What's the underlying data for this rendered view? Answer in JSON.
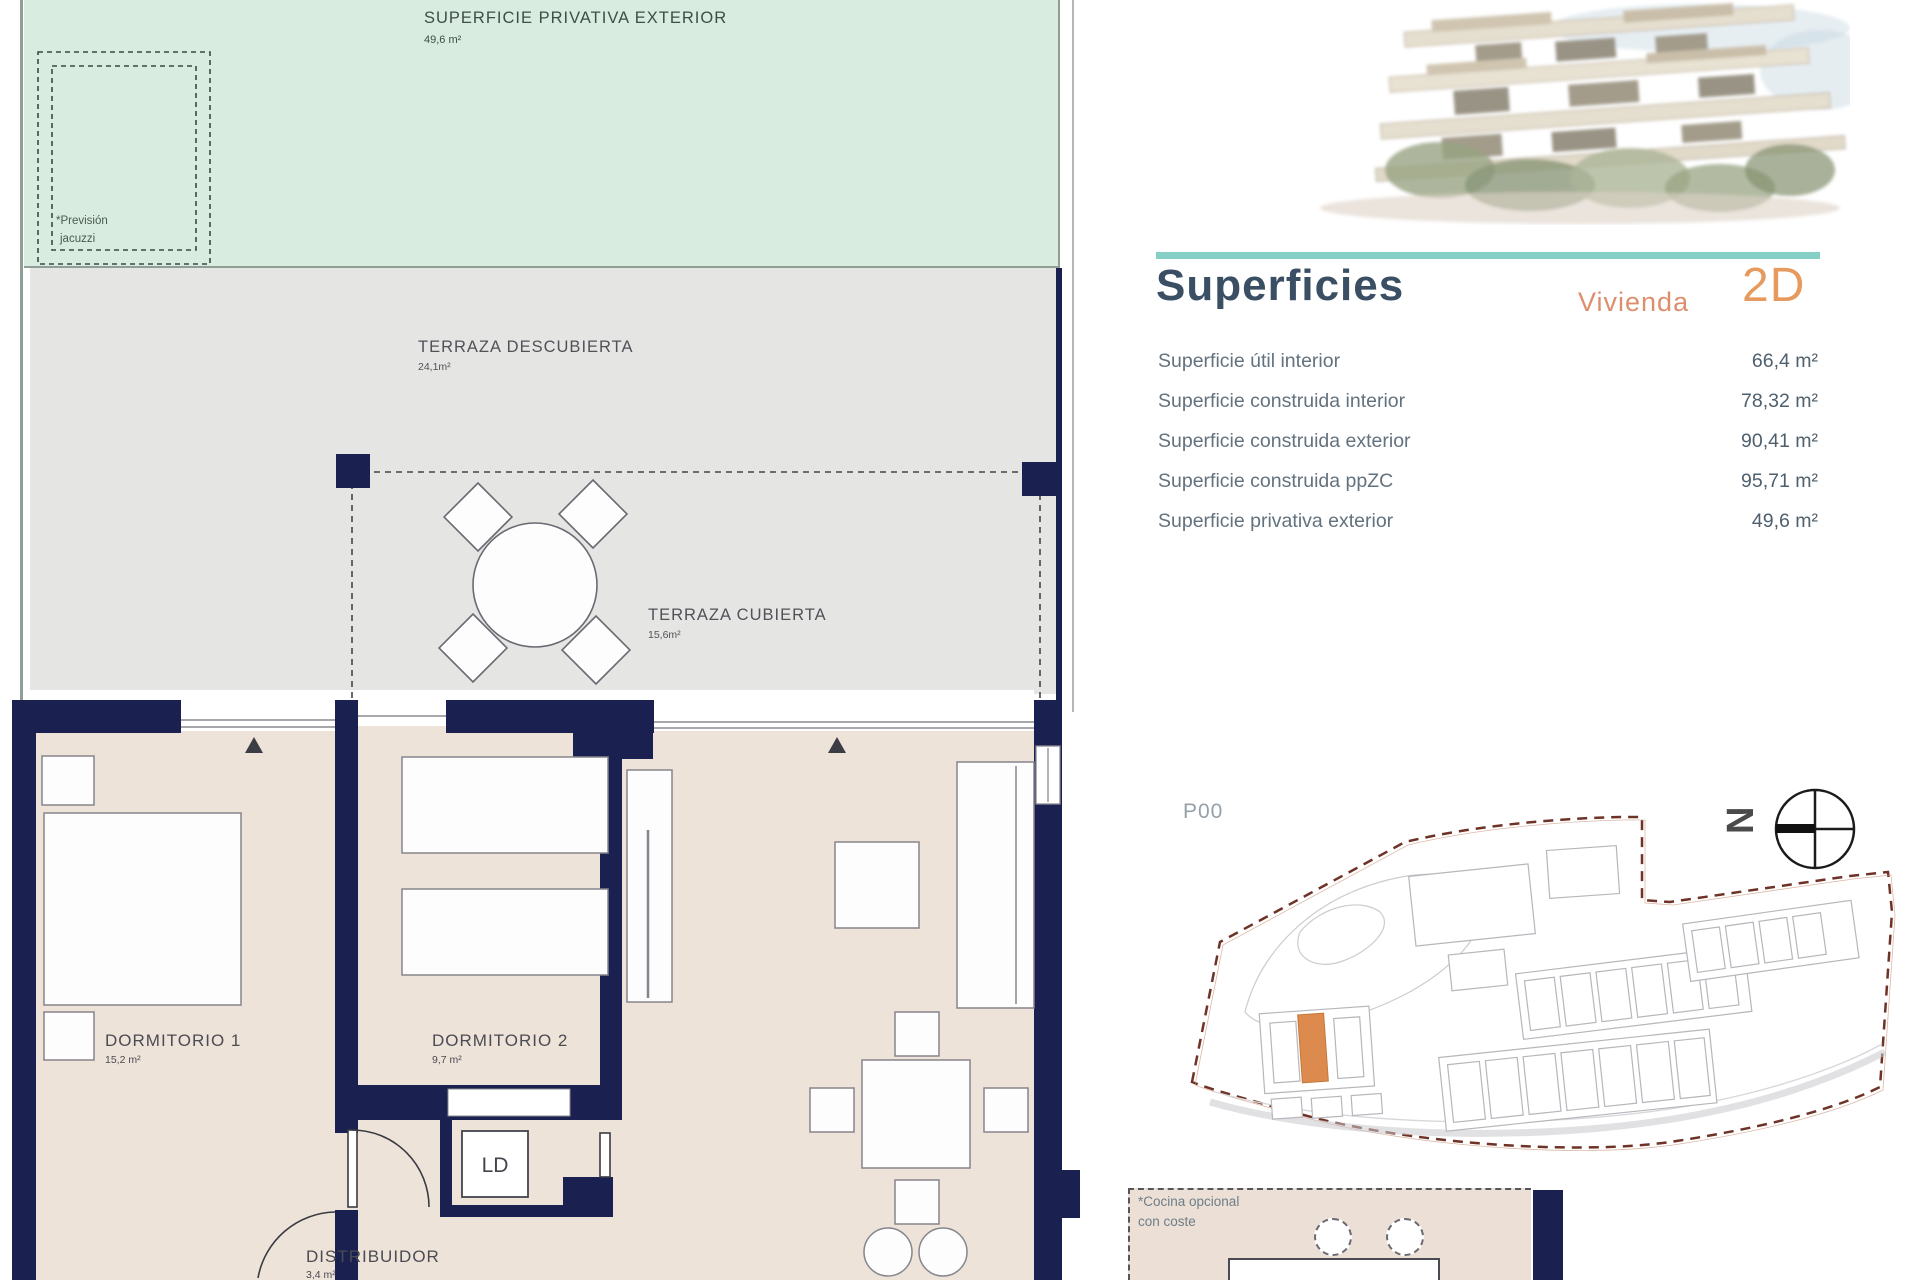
{
  "plan": {
    "superficie_privativa": {
      "label": "SUPERFICIE PRIVATIVA EXTERIOR",
      "area": "49,6 m²"
    },
    "jacuzzi_note": {
      "line1": "*Previsión",
      "line2": "jacuzzi"
    },
    "terraza_descubierta": {
      "label": "TERRAZA DESCUBIERTA",
      "area": "24,1m²"
    },
    "terraza_cubierta": {
      "label": "TERRAZA CUBIERTA",
      "area": "15,6m²"
    },
    "dormitorio_1": {
      "label": "DORMITORIO 1",
      "area": "15,2 m²"
    },
    "dormitorio_2": {
      "label": "DORMITORIO 2",
      "area": "9,7 m²"
    },
    "distribuidor": {
      "label": "DISTRIBUIDOR",
      "area": "3,4 m²"
    },
    "ld": {
      "label": "LD"
    }
  },
  "summary": {
    "title": "Superficies",
    "unit_label": "Vivienda",
    "unit_code": "2D",
    "rows": [
      {
        "label": "Superficie útil interior",
        "value": "66,4 m²"
      },
      {
        "label": "Superficie construida interior",
        "value": "78,32 m²"
      },
      {
        "label": "Superficie construida exterior",
        "value": "90,41 m²"
      },
      {
        "label": "Superficie construida ppZC",
        "value": "95,71 m²"
      },
      {
        "label": "Superficie privativa exterior",
        "value": "49,6 m²"
      }
    ]
  },
  "site": {
    "floor_label": "P00",
    "compass_letter": "N",
    "kitchen_note": {
      "line1": "*Cocina opcional",
      "line2": "con coste"
    }
  },
  "colors": {
    "accent_teal": "#85cfc5",
    "wall_navy": "#1a2150",
    "mint_green": "#d8ecdf",
    "terrace_gray": "#e5e5e3",
    "interior_beige": "#eee3d9",
    "orange_accent": "#dd8a4f",
    "title_blue": "#3a4f63",
    "unit_orange": "#e79a5d",
    "boundary_red": "#6e3226"
  }
}
